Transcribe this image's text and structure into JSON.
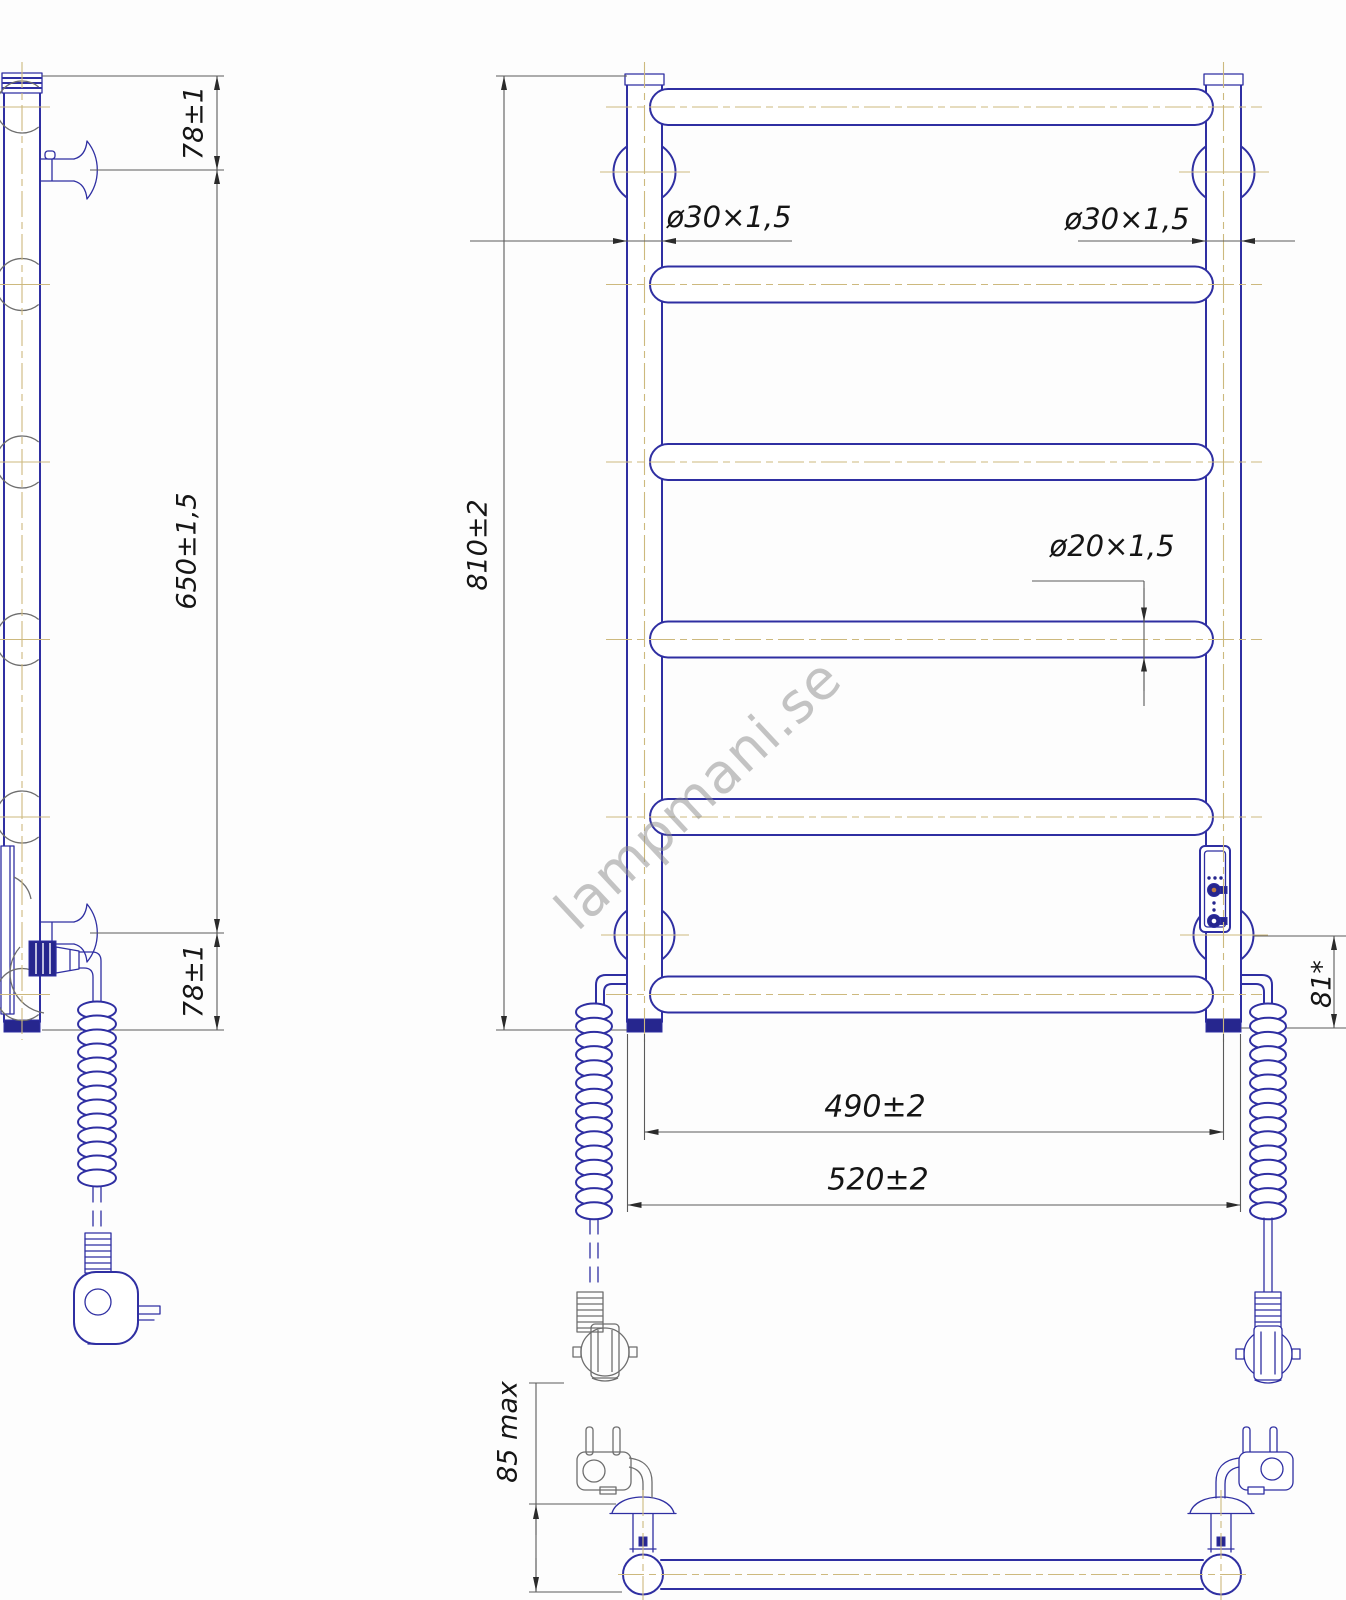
{
  "drawing": {
    "watermark": "lampmani.se",
    "side_view": {
      "dim_top_offset": "78±1",
      "dim_bracket_span": "650±1,5",
      "dim_bottom_offset": "78±1"
    },
    "front_view": {
      "dim_total_height": "810±2",
      "dim_post_diameter_left": "ø30×1,5",
      "dim_post_diameter_right": "ø30×1,5",
      "dim_rung_diameter": "ø20×1,5",
      "dim_lower_rung_offset": "81*",
      "dim_mount_spacing": "490±2",
      "dim_overall_width": "520±2"
    },
    "bottom_view": {
      "dim_wall_clearance": "85 max"
    },
    "colors": {
      "outline": "#2f2fa2",
      "centerline": "#cdb97e",
      "dimension_line": "#5a5a5a",
      "text": "#151515",
      "watermark": "#8f8f8f"
    }
  }
}
